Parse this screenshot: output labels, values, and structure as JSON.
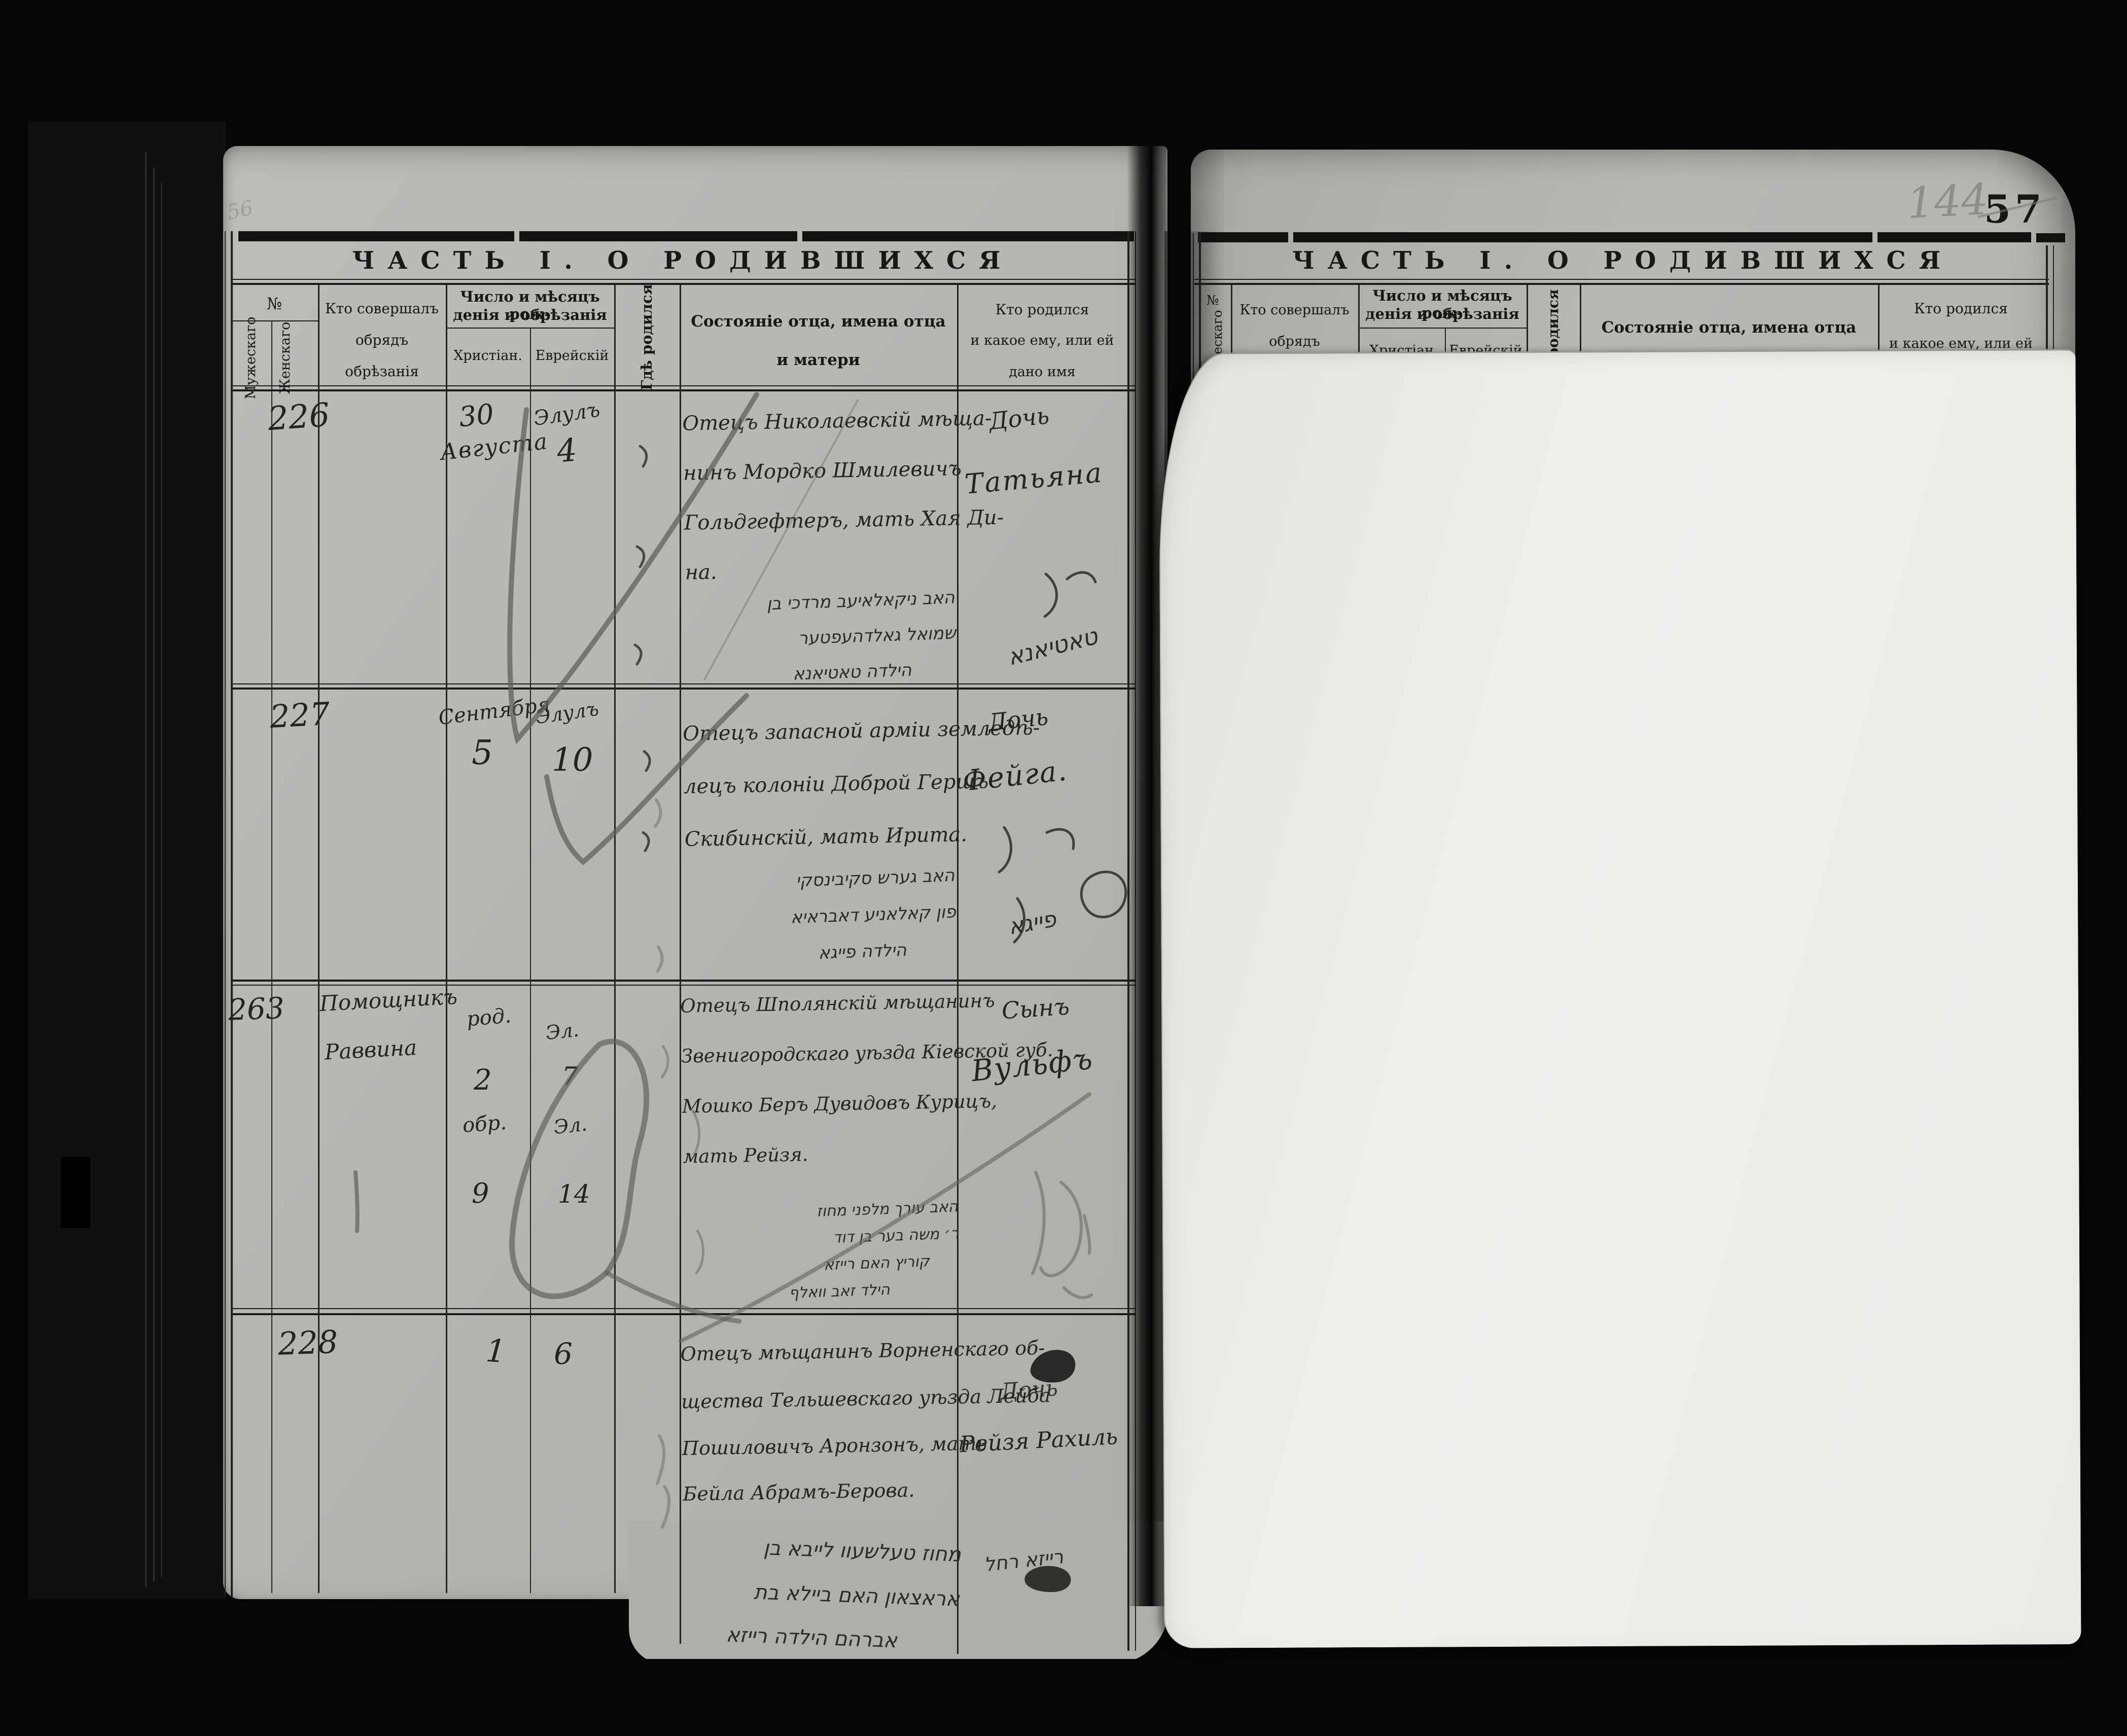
{
  "folio": {
    "penciled_number": "144",
    "printed_number": "57",
    "corner_pencil_note": "56"
  },
  "left_page": {
    "title": "ЧАСТЬ I. О РОДИВШИХСЯ",
    "columns": {
      "number": "№",
      "male": "Мужескаго",
      "female": "Женскаго",
      "officiant": [
        "Кто совершалъ",
        "обрядъ",
        "обрѣзанія"
      ],
      "dates": [
        "Число и мѣсяцъ рож-",
        "денія и обрѣзанія"
      ],
      "christian": "Христіан.",
      "jewish": "Еврейскій",
      "where_born": "Гдѣ родился",
      "father": [
        "Состояніе отца, имена отца",
        "и матери"
      ],
      "who_born": [
        "Кто родился",
        "и какое ему, или ей",
        "дано имя"
      ]
    },
    "entries": [
      {
        "number": "226",
        "date_christian_day": "30",
        "date_christian_month": "Августа",
        "date_jewish_month": "Элулъ",
        "date_jewish_day": "4",
        "father": [
          "Отецъ Николаевскій мѣща-",
          "нинъ Мордко Шмилевичъ",
          "Гольдгефтеръ, мать Хая Ди-",
          "на."
        ],
        "hebrew": [
          "האב ניקאלאיעב מרדכי בן",
          "שמואל גאלדהעפטער",
          "הילדה טאטיאנא"
        ],
        "child_line1": "Дочь",
        "child_line2": "Татьяна",
        "child_hebrew": "טאטיאנא"
      },
      {
        "number": "227",
        "date_christian_month": "Сентября",
        "date_christian_day": "5",
        "date_jewish_month": "Элулъ",
        "date_jewish_day": "10",
        "father": [
          "Отецъ запасной арміи земледѣ-",
          "лецъ колоніи Доброй Гершъ",
          "Скибинскій, мать Ирита."
        ],
        "hebrew": [
          "האב גערש סקיבינסקי",
          "פון קאלאניע דאבראיא",
          "הילדה פייגא"
        ],
        "child_line1": "Дочь",
        "child_line2": "Фейга.",
        "child_hebrew": "פייגא"
      },
      {
        "number": "263",
        "officiant_line1": "Помощникъ",
        "officiant_line2": "Раввина",
        "date_christian_born_label": "род.",
        "date_christian_born": "2",
        "date_christian_circ_label": "обр.",
        "date_christian_circ": "9",
        "date_jewish_born_label": "Эл.",
        "date_jewish_born": "7",
        "date_jewish_circ_label": "Эл.",
        "date_jewish_circ": "14",
        "father": [
          "Отецъ Шполянскій мѣщанинъ",
          "Звенигородскаго уѣзда Кіевской губ.",
          "Мошко Беръ Дувидовъ Курицъ,",
          "мать Рейзя."
        ],
        "hebrew": [
          "האב עורך מלפני מחוז",
          "ר׳ משה בער בן דוד",
          "קוריץ האם רייזא",
          "הילד זאב וואלף"
        ],
        "child_line1": "Сынъ",
        "child_line2": "Вульфъ"
      },
      {
        "number": "228",
        "date_christian_day": "1",
        "date_jewish_day": "6",
        "father": [
          "Отецъ мѣщанинъ Ворненскаго об-",
          "щества Тельшевскаго уѣзда Лейба",
          "Пошиловичъ Аронзонъ, мать",
          "Бейла Абрамъ-Берова."
        ],
        "hebrew": [
          "מחוז טעלשעוו לייבא בן",
          "אראצאון האם ביילא בת",
          "אברהם הילדה רייזא"
        ],
        "child_line1": "Дочь",
        "child_line2": "Рейзя Рахиль",
        "child_hebrew": "רייזא רחל"
      }
    ]
  },
  "right_page": {
    "title": "ЧАСТЬ I. О РОДИВШИХСЯ",
    "columns": {
      "number": "№",
      "male_partial": "ескаго",
      "officiant": [
        "Кто совершалъ",
        "обрядъ"
      ],
      "dates": [
        "Число и мѣсяцъ рож-",
        "денія и обрѣзанія"
      ],
      "christian": "Христіан",
      "jewish": "Еврейскій",
      "where_born": "родился",
      "father": [
        "Состояніе отца, имена отца",
        "и матери"
      ],
      "who_born": [
        "Кто родился",
        "и какое ему, или ей"
      ]
    }
  }
}
